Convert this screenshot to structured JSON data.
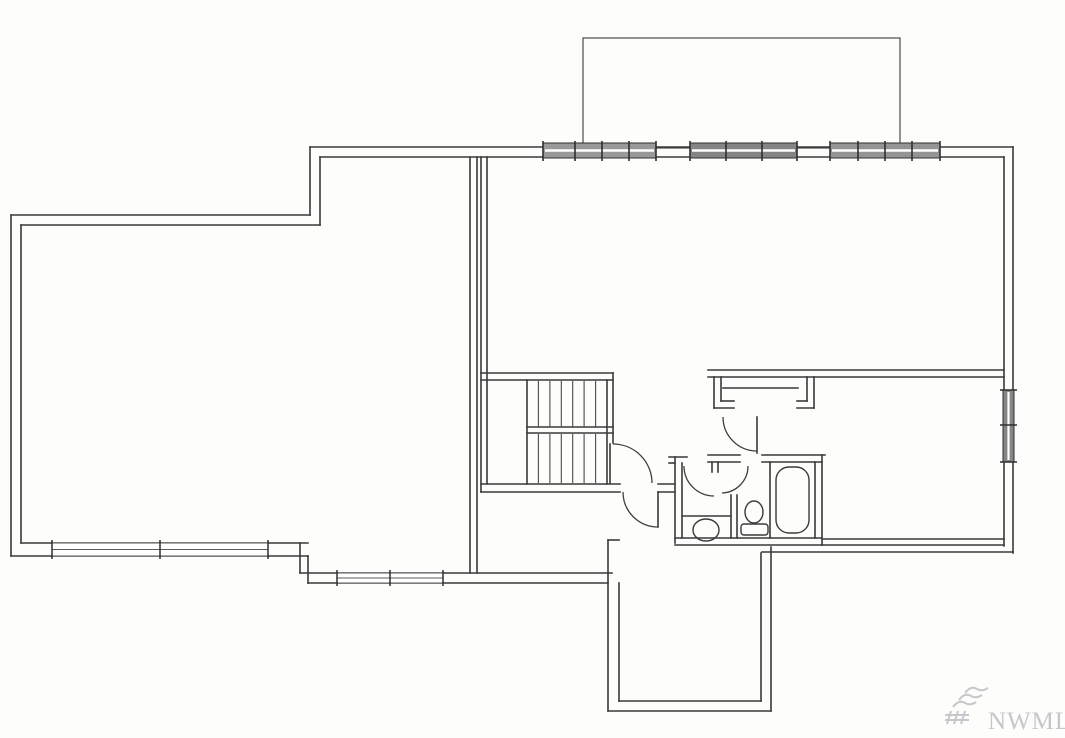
{
  "canvas": {
    "width": 1065,
    "height": 738,
    "background": "#fdfdfc"
  },
  "style": {
    "wall_color": "#3a3a3a",
    "wall_width": 1.6,
    "thin_color": "#4a4a4a",
    "thin_width": 1.1,
    "arc_color": "#3f3f3f",
    "arc_width": 1.3,
    "deck_color": "#4a4a4a",
    "deck_width": 1.2,
    "window_stroke": "#2f2f2f",
    "window_mid_stroke": "#ffffff",
    "plain_window_stroke": "#5a5a5a",
    "watermark_color": "#c7c7cb",
    "watermark_font_size": 25
  },
  "watermark": {
    "text": "NWMLS",
    "x": 988,
    "y": 729,
    "logo_paths": [
      "M945,715 h24",
      "M945,720 h24",
      "M951,711 l-4,13",
      "M958,711 l-4,13",
      "M965,711 l-4,13",
      "M953,707 q6,-8 12,-4 q5,3 11,-1",
      "M959,700 q6,-8 12,-4 q5,3 11,-1",
      "M965,693 q6,-8 12,-4 q5,3 11,-1"
    ]
  },
  "deck": {
    "x": 583,
    "y": 38,
    "w": 317,
    "h": 110
  },
  "walls": [
    [
      310,
      147,
      1013,
      147
    ],
    [
      320,
      157,
      1004,
      157
    ],
    [
      1013,
      147,
      1013,
      553
    ],
    [
      1004,
      157,
      1004,
      546
    ],
    [
      310,
      147,
      310,
      215
    ],
    [
      320,
      157,
      320,
      225
    ],
    [
      11,
      215,
      310,
      215
    ],
    [
      21,
      225,
      320,
      225
    ],
    [
      11,
      215,
      11,
      556
    ],
    [
      21,
      225,
      21,
      543
    ],
    [
      21,
      543,
      308,
      543
    ],
    [
      11,
      556,
      308,
      556
    ],
    [
      308,
      556,
      308,
      583
    ],
    [
      300,
      543,
      300,
      573
    ],
    [
      300,
      573,
      612,
      573
    ],
    [
      308,
      583,
      608,
      583
    ],
    [
      470,
      157,
      470,
      573
    ],
    [
      477,
      157,
      477,
      573
    ],
    [
      481,
      157,
      481,
      492
    ],
    [
      487,
      157,
      487,
      484
    ],
    [
      481,
      373,
      613,
      373
    ],
    [
      481,
      380,
      613,
      380
    ],
    [
      613,
      373,
      613,
      443
    ],
    [
      607,
      380,
      607,
      484
    ],
    [
      527,
      380,
      527,
      484
    ],
    [
      527,
      427,
      613,
      427
    ],
    [
      527,
      433,
      613,
      433
    ],
    [
      481,
      484,
      620,
      484
    ],
    [
      481,
      492,
      620,
      492
    ],
    [
      658,
      484,
      675,
      484
    ],
    [
      658,
      492,
      675,
      492
    ],
    [
      669,
      457,
      687,
      457
    ],
    [
      675,
      457,
      675,
      543
    ],
    [
      682,
      463,
      682,
      538
    ],
    [
      669,
      463,
      675,
      463
    ],
    [
      708,
      455,
      740,
      455
    ],
    [
      708,
      462,
      740,
      462
    ],
    [
      712,
      462,
      712,
      472
    ],
    [
      718,
      462,
      718,
      472
    ],
    [
      762,
      455,
      825,
      455
    ],
    [
      762,
      462,
      822,
      462
    ],
    [
      815,
      462,
      815,
      538
    ],
    [
      822,
      455,
      822,
      545
    ],
    [
      731,
      495,
      731,
      538
    ],
    [
      737,
      495,
      737,
      538
    ],
    [
      682,
      516,
      731,
      516
    ],
    [
      675,
      538,
      822,
      538
    ],
    [
      675,
      545,
      822,
      545
    ],
    [
      708,
      370,
      1004,
      370
    ],
    [
      708,
      377,
      1004,
      377
    ],
    [
      723,
      388,
      798,
      388
    ],
    [
      714,
      377,
      714,
      408
    ],
    [
      714,
      408,
      734,
      408
    ],
    [
      721,
      377,
      721,
      401
    ],
    [
      721,
      401,
      734,
      401
    ],
    [
      814,
      377,
      814,
      408
    ],
    [
      797,
      408,
      814,
      408
    ],
    [
      807,
      377,
      807,
      401
    ],
    [
      797,
      401,
      807,
      401
    ],
    [
      757,
      417,
      757,
      453
    ],
    [
      822,
      539,
      1004,
      539
    ],
    [
      822,
      545,
      1004,
      545
    ],
    [
      762,
      552,
      1013,
      552
    ],
    [
      608,
      540,
      608,
      711
    ],
    [
      619,
      583,
      619,
      701
    ],
    [
      608,
      540,
      619,
      540
    ],
    [
      608,
      711,
      771,
      711
    ],
    [
      619,
      701,
      761,
      701
    ],
    [
      771,
      547,
      771,
      711
    ],
    [
      761,
      553,
      761,
      701
    ],
    [
      610,
      444,
      610,
      483
    ],
    [
      658,
      492,
      658,
      527
    ],
    [
      770,
      462,
      770,
      538
    ]
  ],
  "stairs": {
    "tread_xs": [
      538.4,
      549.9,
      561.3,
      572.7,
      584.1,
      595.6
    ],
    "upper_run": [
      381,
      427
    ],
    "lower_run": [
      434,
      483
    ]
  },
  "door_arcs": [
    "M 613,444 A 39 39 0 0 1 652,483",
    "M 623,492 A 35 35 0 0 0 658,527",
    "M 684,466 A 30 30 0 0 0 714,496",
    "M 748,466 A 27 27 0 0 1 722,493",
    "M 723,417 A 34 34 0 0 0 757,451"
  ],
  "windows_top": [
    {
      "x": 543,
      "y": 143,
      "w": 113,
      "h": 15,
      "fill": "#999999",
      "mullions": [
        543,
        575,
        602,
        629,
        656
      ]
    },
    {
      "x": 690,
      "y": 143,
      "w": 107,
      "h": 15,
      "fill": "#858585",
      "mullions": [
        690,
        726,
        762,
        797
      ]
    },
    {
      "x": 830,
      "y": 143,
      "w": 110,
      "h": 15,
      "fill": "#949494",
      "mullions": [
        830,
        858,
        885,
        912,
        940
      ]
    }
  ],
  "window_right": {
    "x": 1003,
    "y": 390,
    "w": 11,
    "h": 72,
    "fill": "#858585",
    "mullions_y": [
      390,
      425,
      462
    ]
  },
  "windows_bottom": [
    {
      "x": 52,
      "y": 543,
      "w": 216,
      "h": 13,
      "mullions": [
        52,
        160,
        268
      ]
    },
    {
      "x": 337,
      "y": 573,
      "w": 106,
      "h": 10,
      "mullions": [
        337,
        390,
        443
      ]
    }
  ],
  "fixtures": [
    {
      "name": "toilet",
      "type": "ellipse",
      "cx": 706,
      "cy": 530,
      "rx": 13,
      "ry": 11
    },
    {
      "name": "sink-bowl",
      "type": "ellipse",
      "cx": 754,
      "cy": 512,
      "rx": 9,
      "ry": 11
    },
    {
      "name": "sink-base",
      "type": "rect",
      "x": 741,
      "y": 524,
      "w": 27,
      "h": 11,
      "rx": 3
    },
    {
      "name": "bathtub-inner",
      "type": "rect",
      "x": 776,
      "y": 467,
      "w": 33,
      "h": 66,
      "rx": 13
    }
  ]
}
